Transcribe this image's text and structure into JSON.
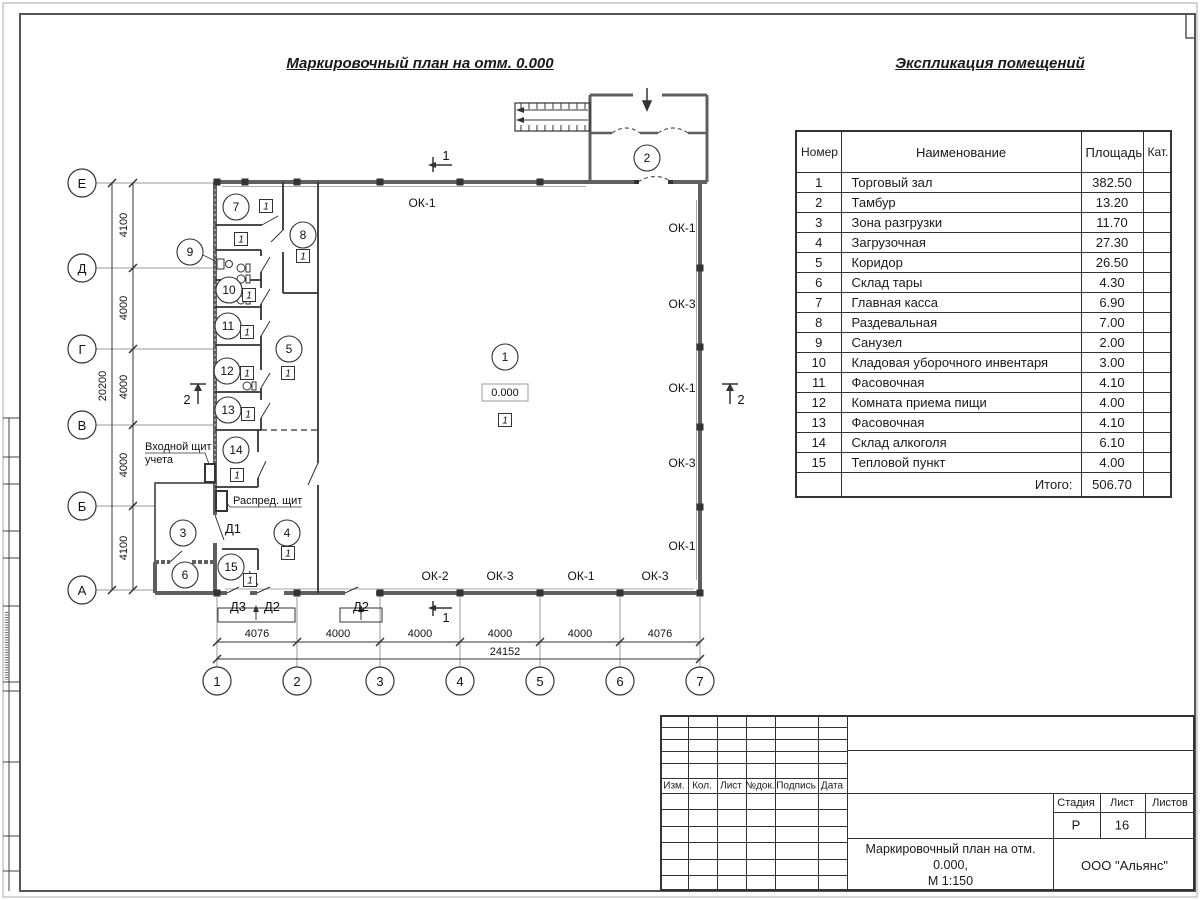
{
  "sheet": {
    "plan_title": "Маркировочный план на отм. 0.000",
    "table_title": "Экспликация помещений"
  },
  "explication": {
    "headers": {
      "num": "Номер помещ.",
      "name": "Наименование",
      "area": "Площадь",
      "cat": "Кат. пом."
    },
    "rows": [
      {
        "num": "1",
        "name": "Торговый зал",
        "area": "382.50"
      },
      {
        "num": "2",
        "name": "Тамбур",
        "area": "13.20"
      },
      {
        "num": "3",
        "name": "Зона разгрузки",
        "area": "11.70"
      },
      {
        "num": "4",
        "name": "Загрузочная",
        "area": "27.30"
      },
      {
        "num": "5",
        "name": "Коридор",
        "area": "26.50"
      },
      {
        "num": "6",
        "name": "Склад тары",
        "area": "4.30"
      },
      {
        "num": "7",
        "name": "Главная касса",
        "area": "6.90"
      },
      {
        "num": "8",
        "name": "Раздевальная",
        "area": "7.00"
      },
      {
        "num": "9",
        "name": "Санузел",
        "area": "2.00"
      },
      {
        "num": "10",
        "name": "Кладовая уборочного инвентаря",
        "area": "3.00"
      },
      {
        "num": "11",
        "name": "Фасовочная",
        "area": "4.10"
      },
      {
        "num": "12",
        "name": "Комната приема пищи",
        "area": "4.00"
      },
      {
        "num": "13",
        "name": "Фасовочная",
        "area": "4.10"
      },
      {
        "num": "14",
        "name": "Склад алкоголя",
        "area": "6.10"
      },
      {
        "num": "15",
        "name": "Тепловой пункт",
        "area": "4.00"
      }
    ],
    "total_label": "Итого:",
    "total_area": "506.70"
  },
  "plan": {
    "level_mark": "0.000",
    "door_mark": "1",
    "room_numbers": [
      "1",
      "2",
      "3",
      "4",
      "5",
      "6",
      "7",
      "8",
      "9",
      "10",
      "11",
      "12",
      "13",
      "14",
      "15"
    ],
    "axes": {
      "rows": [
        "Е",
        "Д",
        "Г",
        "В",
        "Б",
        "А"
      ],
      "cols": [
        "1",
        "2",
        "3",
        "4",
        "5",
        "6",
        "7"
      ]
    },
    "dimensions": {
      "vertical": [
        "4100",
        "4000",
        "4000",
        "4000",
        "4100"
      ],
      "vertical_total": "20200",
      "horizontal": [
        "4076",
        "4000",
        "4000",
        "4000",
        "4000",
        "4076"
      ],
      "horizontal_total": "24152"
    },
    "windows": {
      "top": "ОК-1",
      "right": [
        "ОК-1",
        "ОК-3",
        "ОК-1",
        "ОК-3",
        "ОК-1"
      ],
      "bottom": [
        "ОК-2",
        "ОК-3",
        "ОК-1",
        "ОК-3"
      ]
    },
    "doors": {
      "d1": "Д1",
      "d2": "Д2",
      "d3": "Д3"
    },
    "section_marks": {
      "one": "1",
      "two": "2"
    },
    "labels": {
      "entry_panel_line1": "Входной щит",
      "entry_panel_line2": "учета",
      "distribution_panel": "Распред. щит"
    }
  },
  "title_block": {
    "columns": [
      "Изм.",
      "Кол.",
      "Лист",
      "№док.",
      "Подпись",
      "Дата"
    ],
    "stage_label": "Стадия",
    "sheet_label": "Лист",
    "sheets_label": "Листов",
    "stage_value": "Р",
    "sheet_value": "16",
    "doc_title_line1": "Маркировочный план на отм. 0.000,",
    "doc_title_line2": "М 1:150",
    "company": "ООО \"Альянс\""
  }
}
